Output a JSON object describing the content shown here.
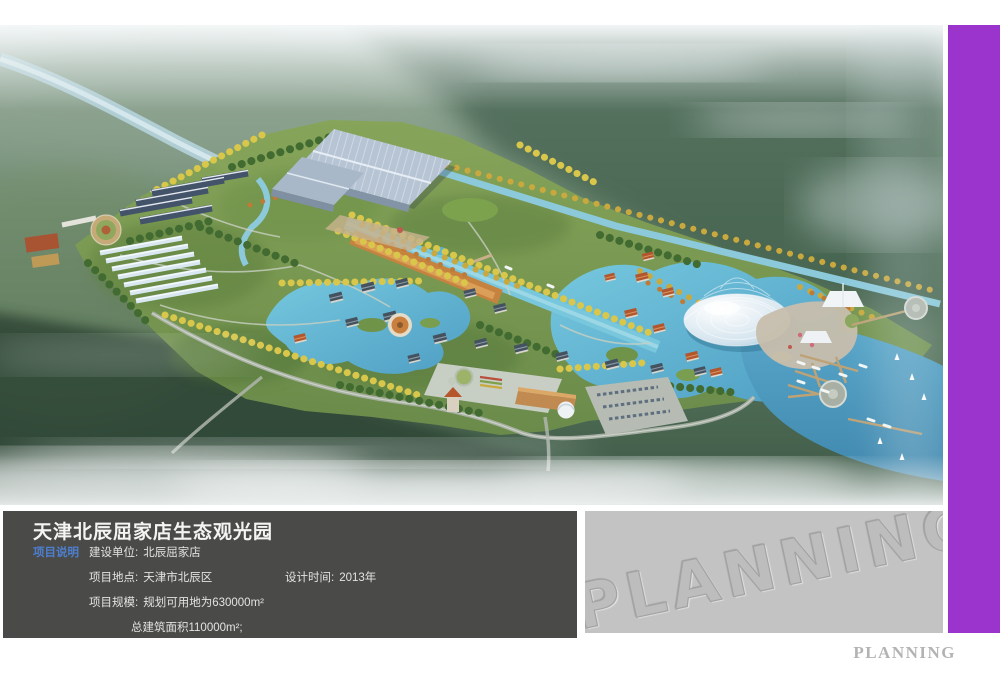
{
  "colors": {
    "accent_bar": "#9a34cd",
    "info_panel_bg": "#4a4a48",
    "section_label_blue": "#4d7fd0",
    "watermark_box_bg": "#c3c3c3"
  },
  "info_panel": {
    "title": "天津北辰屈家店生态观光园",
    "section_label": "项目说明",
    "builder_label": "建设单位:",
    "builder_value": "北辰屈家店",
    "location_label": "项目地点:",
    "location_value": "天津市北辰区",
    "design_time_label": "设计时间:",
    "design_time_value": "2013年",
    "scale_label": "项目规模:",
    "scale_value": "规划可用地为630000m²",
    "area_value": "总建筑面积110000m²;"
  },
  "watermark": {
    "text": "PLANNING"
  },
  "footer": {
    "brand": "PLANNING"
  }
}
